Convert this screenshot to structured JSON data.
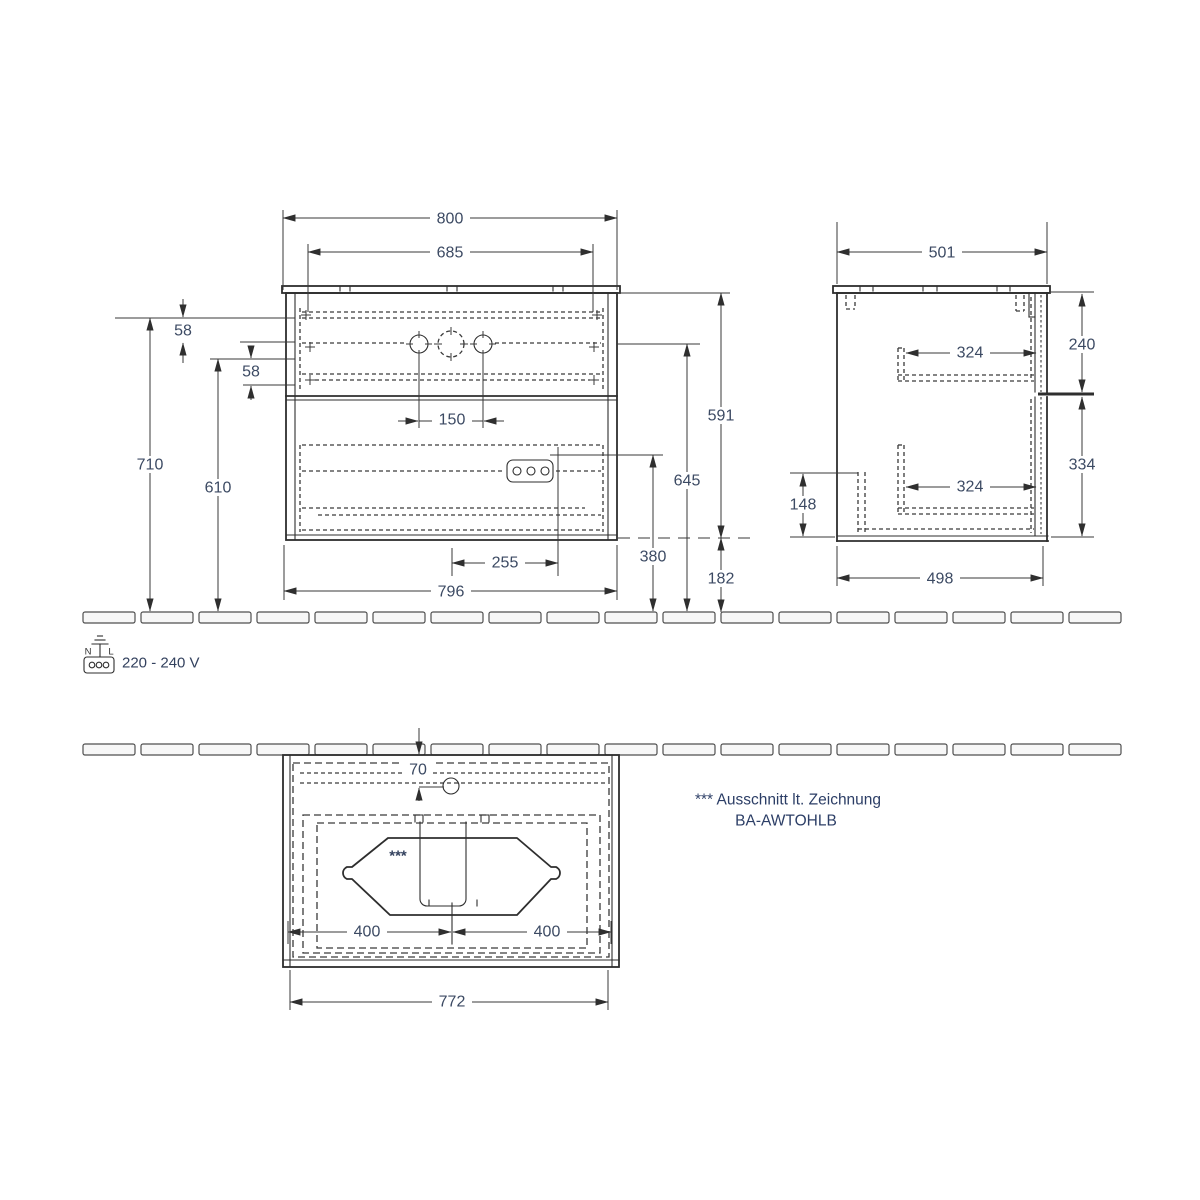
{
  "front_view": {
    "overall_width": "800",
    "inner_width": "685",
    "tap_spacing": "150",
    "offset_top": "58",
    "offset_mid": "58",
    "height_total": "710",
    "height_inner": "610",
    "height_carcass": "591",
    "height_tap": "645",
    "height_socket": "380",
    "bottom_gap": "182",
    "socket_offset": "255",
    "carcass_width": "796"
  },
  "side_view": {
    "depth_top": "501",
    "upper_drawer_depth": "324",
    "lower_drawer_depth": "324",
    "upper_drawer_height": "240",
    "lower_drawer_height": "334",
    "rear_clearance": "148",
    "depth_bottom": "498"
  },
  "top_view": {
    "tap_offset": "70",
    "center_left": "400",
    "center_right": "400",
    "front_width": "772",
    "cutout_marker": "***"
  },
  "power": {
    "terminal_left": "N",
    "terminal_right": "L",
    "voltage": "220 - 240 V"
  },
  "note": {
    "line1": "*** Ausschnitt lt. Zeichnung",
    "line2": "BA-AWTOHLB"
  }
}
